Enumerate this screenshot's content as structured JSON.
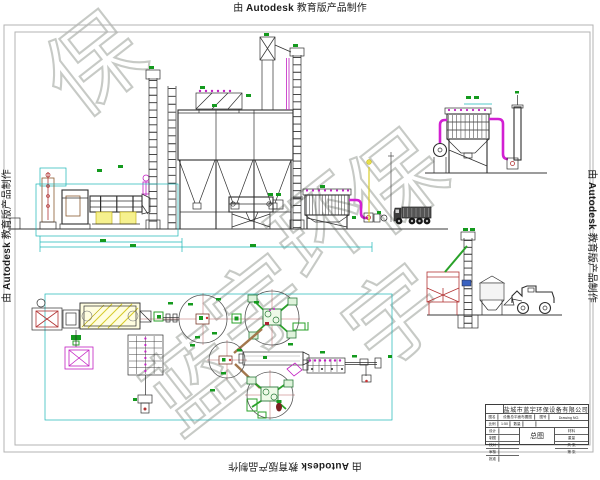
{
  "edge_watermark": {
    "prefix": "由",
    "brand": "Autodesk",
    "suffix": "教育版产品制作"
  },
  "diagonal_watermark": {
    "text": "蓝宇环保",
    "chars": [
      "蓝",
      "宇",
      "环",
      "保"
    ],
    "partial_chars": [
      "保",
      "宇"
    ],
    "color": "#c7cac6"
  },
  "title_block": {
    "company": "盐城市蓝宇环保设备有限公司",
    "name_label": "图名",
    "drawing_name": "设备总平面布置图",
    "no_label": "图号",
    "drawing_no_en": "Drawing NO.",
    "scale_label": "比例",
    "scale_value": "1:50",
    "qty_label": "数量",
    "center_title": "总图",
    "sign_labels": [
      "设计",
      "制图",
      "校对",
      "审核",
      "批准"
    ],
    "right_labels": [
      "材料",
      "重量",
      "共 张",
      "第 张"
    ]
  },
  "colors": {
    "duct_magenta": "#d21fd2",
    "dimension_green": "#149a1e",
    "boundary_cyan": "#1ab6b6",
    "support_yellow": "#f6f18e",
    "equipment_red": "#b23434",
    "frame_gray": "#b3b3b3"
  }
}
